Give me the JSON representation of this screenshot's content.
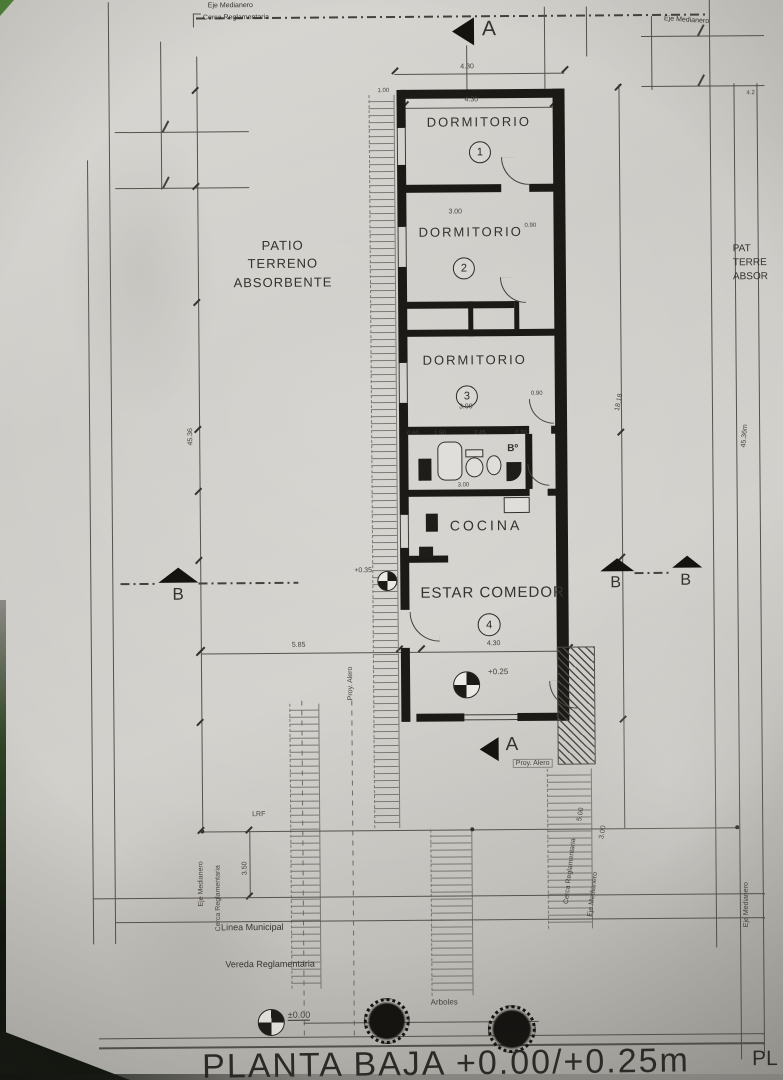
{
  "title": "PLANTA BAJA +0.00/+0.25m",
  "corner": "PL",
  "rooms": {
    "dorm1": {
      "label": "DORMITORIO",
      "num": "1"
    },
    "dorm2": {
      "label": "DORMITORIO",
      "num": "2"
    },
    "dorm3": {
      "label": "DORMITORIO",
      "num": "3"
    },
    "cocina": {
      "label": "COCINA"
    },
    "estar": {
      "label": "ESTAR COMEDOR",
      "num": "4"
    },
    "bano": {
      "label": "Bº"
    }
  },
  "zones": {
    "patio_left": "PATIO\nTERRENO\nABSORBENTE",
    "patio_right": "PAT\nTERRE\nABSOR"
  },
  "sections": {
    "a": "A",
    "b": "B"
  },
  "site": {
    "eje_medianero": "Eje Medianero",
    "cerca_reglamentaria": "Cerca Reglamentaria",
    "linea_municipal": "Linea Municipal",
    "vereda_reglamentaria": "Vereda Reglamentaria",
    "proy_alero": "Proy. Alero",
    "arboles": "Arboles",
    "lrf": "LRF"
  },
  "levels": {
    "l035": "+0.35",
    "l025": "+0.25",
    "l000": "±0.00"
  },
  "dims": {
    "top_total": "4.30",
    "small_top": "1.00",
    "dorm1_w": "4.30",
    "dorm2_w": "3.00",
    "dorm2_r": "0.90",
    "dorm3_w": "3.00",
    "dorm3_r": "0.90",
    "bath1": "0.60",
    "bath2": "1.50",
    "bath3": "2.45",
    "bath4": "0.30",
    "bath_w": "3.00",
    "estar_w": "4.30",
    "patio_w": "5.85",
    "left_depth": "45.36",
    "right_depth": "18.18",
    "far_right_depth": "45.36m",
    "front_left": "3.50",
    "front_r1": "5.00",
    "front_r2": "3.00",
    "top_right": "4.2"
  }
}
